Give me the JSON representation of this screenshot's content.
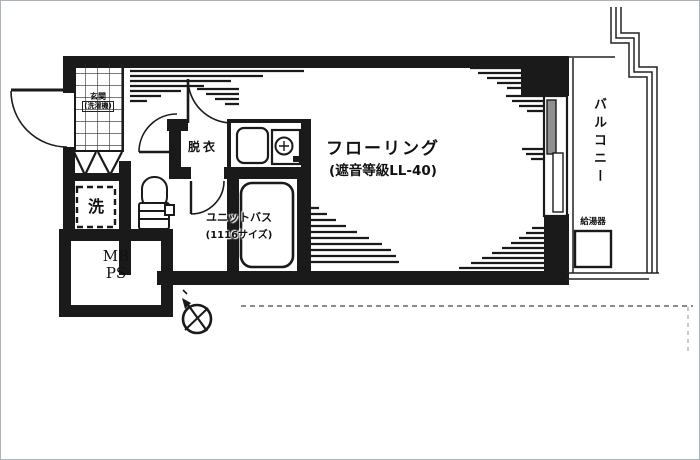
{
  "floorplan": {
    "rooms": {
      "main": {
        "label": "フローリング",
        "note": "(遮音等級LL-40)"
      },
      "balcony": {
        "label": "バルコニー"
      },
      "unit_bath": {
        "label": "ユニットバス",
        "size": "(1116サイズ)"
      },
      "dressing": {
        "label": "脱衣"
      },
      "entrance": {
        "label": "玄関",
        "note": "(洗濯機)"
      },
      "washer": {
        "label": "洗"
      },
      "meter_box": {
        "line1": "MB",
        "line2": "PS"
      },
      "water_heater": {
        "label": "給湯器"
      }
    },
    "colors": {
      "line": "#1a1a1a",
      "pane_gray": "#8f8f8f",
      "bg": "#ffffff"
    }
  }
}
